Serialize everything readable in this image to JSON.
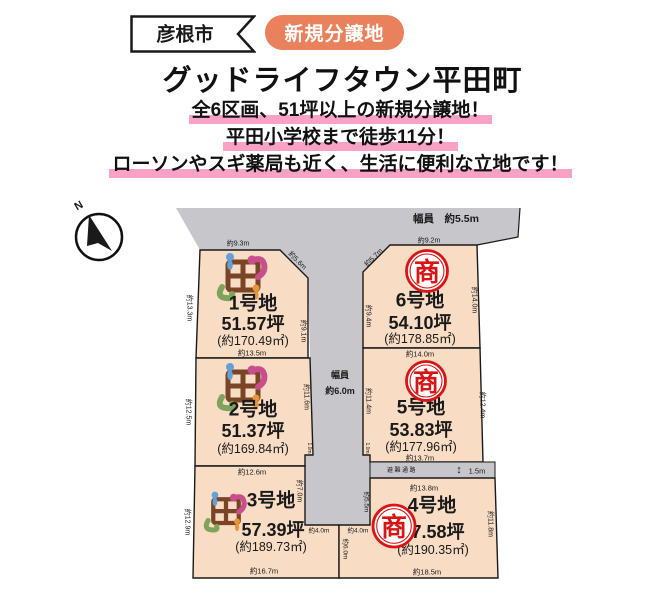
{
  "flyer": {
    "city": "彦根市",
    "badge": "新規分譲地",
    "title": "グッドライフタウン平田町",
    "catch_lines": [
      "全6区画、51坪以上の新規分譲地！",
      "平田小学校まで徒歩11分！",
      "ローソンやスギ薬局も近く、生活に便利な立地です！"
    ]
  },
  "site_plan": {
    "compass": "N",
    "top_road_label": "幅員　約5.5m",
    "center_road_label_line1": "幅員",
    "center_road_label_line2": "約6.0m",
    "evacuation_label": "避難通路",
    "evacuation_width": "1.5m",
    "evacuation_arrow_icon": "↕",
    "lots": [
      {
        "name": "1号地",
        "tsubo": "51.57坪",
        "area": "(約170.49㎡)"
      },
      {
        "name": "2号地",
        "tsubo": "51.37坪",
        "area": "(約169.84㎡)"
      },
      {
        "name": "3号地",
        "tsubo": "57.39坪",
        "area": "(約189.73㎡)"
      },
      {
        "name": "4号地",
        "tsubo": "57.58坪",
        "area": "(約190.35㎡)",
        "stamp": "商"
      },
      {
        "name": "5号地",
        "tsubo": "53.83坪",
        "area": "(約177.96㎡)",
        "stamp": "商"
      },
      {
        "name": "6号地",
        "tsubo": "54.10坪",
        "area": "(約178.85㎡)",
        "stamp": "商"
      }
    ],
    "dimensions": {
      "lot1_top": "約9.3m",
      "lot1_diag": "約5.6m",
      "lot1_left": "約13.3m",
      "lot1_right": "約9.1m",
      "lot1_bottom": "約13.5m",
      "lot2_left": "約12.5m",
      "lot2_right": "約11.6m",
      "lot2_bottom": "約12.6m",
      "lot3_left": "約12.9m",
      "lot3_right_upper": "約7.0m",
      "lot3_bottom": "約16.7m",
      "lot6_top": "約9.2m",
      "lot6_diag": "約5.7m",
      "lot6_left": "約9.4m",
      "lot6_right": "約14.0m",
      "lot6_bottom": "約14.0m",
      "lot5_left": "約11.4m",
      "lot5_right": "約12.4m",
      "lot5_bottom": "約13.7m",
      "lot4_top": "約13.8m",
      "lot4_left_upper": "約5.5m",
      "lot4_right": "約11.8m",
      "lot4_bottom": "約18.5m",
      "road_end_left": "約4.0m",
      "road_end_right": "約4.0m",
      "road_end_divider": "約6.0m",
      "notch_left": "1.0m",
      "notch_right": "1.0m"
    }
  },
  "colors": {
    "badge_orange": "#e8815c",
    "highlight_pink": "#f9a2c6",
    "lot_fill": "#f8dcc4",
    "road_gray": "#c7c7cb",
    "stamp_red": "#d81414",
    "outline_black": "#1a1a1a"
  }
}
